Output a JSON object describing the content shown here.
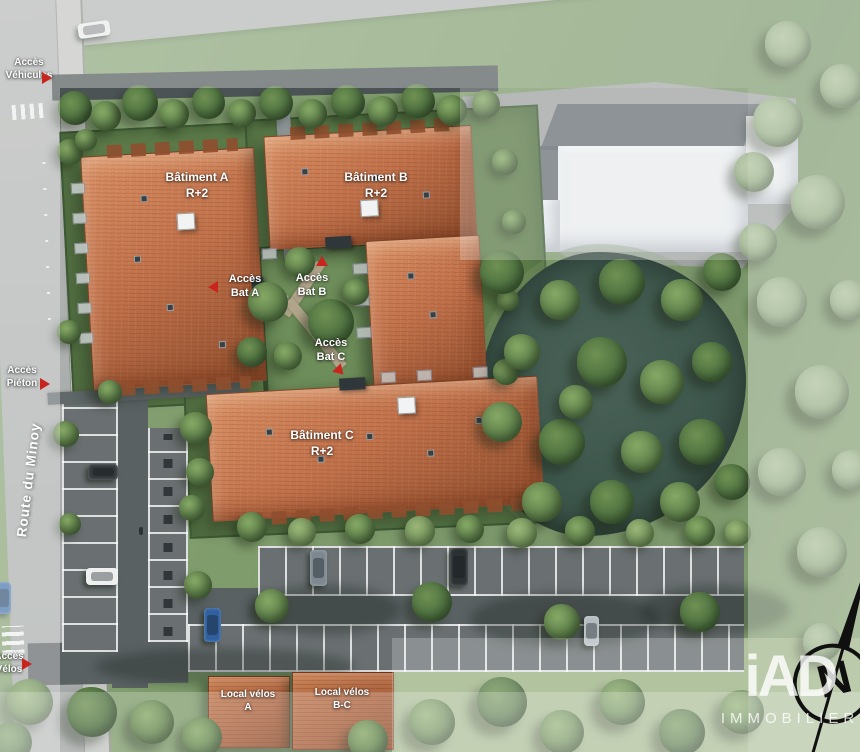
{
  "plan": {
    "kind": "Plan de masse résidentiel",
    "north_letter": "N"
  },
  "street": {
    "name": "Route du Minoy"
  },
  "buildings": [
    {
      "id": "A",
      "name": "Bâtiment A",
      "floors": "R+2"
    },
    {
      "id": "B",
      "name": "Bâtiment B",
      "floors": "R+2"
    },
    {
      "id": "C",
      "name": "Bâtiment C",
      "floors": "R+2"
    }
  ],
  "access_points": [
    {
      "line1": "Accès",
      "line2": "Véhicules"
    },
    {
      "line1": "Accès",
      "line2": "Piéton"
    },
    {
      "line1": "Accès",
      "line2": "Vélos"
    },
    {
      "line1": "Accès",
      "line2": "Bat A"
    },
    {
      "line1": "Accès",
      "line2": "Bat B"
    },
    {
      "line1": "Accès",
      "line2": "Bat C"
    }
  ],
  "bike_sheds": [
    {
      "line1": "Local vélos",
      "line2": "A"
    },
    {
      "line1": "Local vélos",
      "line2": "B-C"
    }
  ],
  "watermark": {
    "brand": "iAD",
    "sub": "IMMOBILIER"
  },
  "colors": {
    "roof": "#c0714a",
    "roof_dark": "#8f4e2d",
    "roof_light": "#d98f63",
    "grass": "#83a06f",
    "grass_dark": "#5d7c4a",
    "hedge": "#3d5a35",
    "pond": "#3f564b",
    "road": "#b2b5b3",
    "asphalt": "#5a6163",
    "white_building": "#e9ecee",
    "label": "#ffffff",
    "red": "#c8251d"
  }
}
